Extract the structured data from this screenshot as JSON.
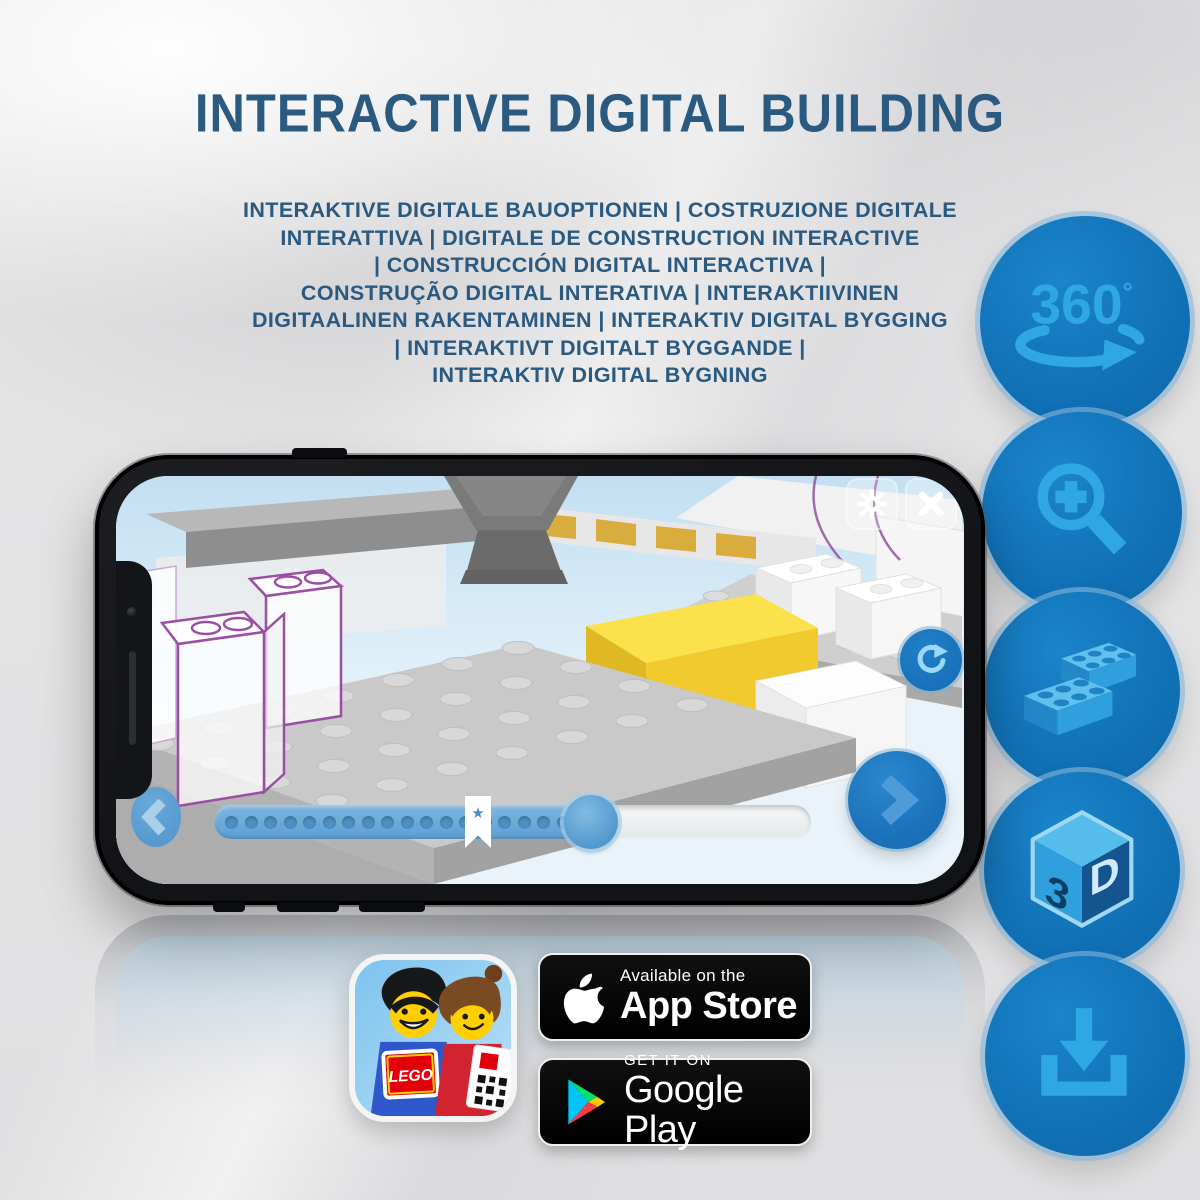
{
  "page": {
    "title": "INTERACTIVE DIGITAL BUILDING",
    "title_color": "#2a5a80",
    "subtitle_lines": [
      "INTERAKTIVE DIGITALE BAUOPTIONEN | COSTRUZIONE DIGITALE",
      "INTERATTIVA | DIGITALE DE CONSTRUCTION INTERACTIVE",
      "| CONSTRUCCIÓN DIGITAL INTERACTIVA |",
      "CONSTRUÇÃO DIGITAL INTERATIVA | INTERAKTIIVINEN",
      "DIGITAALINEN RAKENTAMINEN | INTERAKTIV DIGITAL BYGGING",
      "| INTERAKTIVT DIGITALT BYGGANDE |",
      "INTERAKTIV DIGITAL BYGNING"
    ]
  },
  "feature_icons": [
    {
      "name": "360-rotation-icon",
      "label_number": "360",
      "label_degree": "°"
    },
    {
      "name": "zoom-in-icon"
    },
    {
      "name": "lego-brick-icon"
    },
    {
      "name": "3d-view-icon",
      "face_left": "3",
      "face_right": "D"
    },
    {
      "name": "download-icon"
    }
  ],
  "phone": {
    "ui": {
      "icons": [
        "gear-icon",
        "close-icon",
        "rotate-reset-icon",
        "chevron-left-icon",
        "chevron-right-icon",
        "bookmark-star-icon"
      ],
      "slider": {
        "progress_percent": 63,
        "dot_count": 19,
        "bookmark_glyph": "★"
      }
    }
  },
  "badges": {
    "lego_app": {
      "logo_text": "LEGO"
    },
    "app_store": {
      "tagline": "Available on the",
      "store_name": "App Store"
    },
    "google_play": {
      "tagline": "GET IT ON",
      "store_name": "Google Play"
    }
  },
  "colors": {
    "headline_blue": "#2a5a80",
    "circle_blue": "#1172b7",
    "icon_light_blue": "#2ea7e3",
    "lego_yellow": "#f6d73c",
    "badge_black": "#000000"
  }
}
